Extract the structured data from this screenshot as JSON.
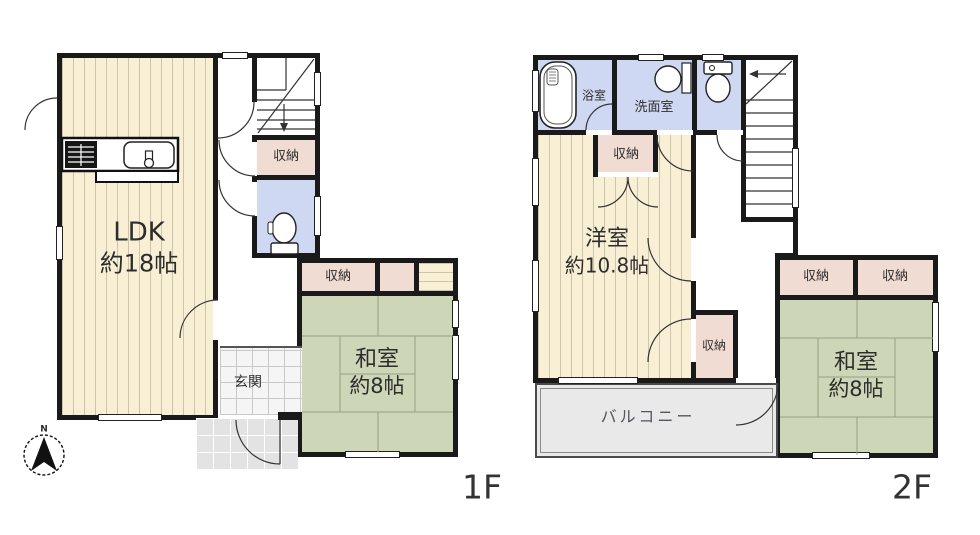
{
  "plan": {
    "floor1": {
      "floor_label": "1F",
      "ldk": {
        "name": "LDK",
        "size": "約18帖"
      },
      "hall_storage": "収納",
      "washitsu": {
        "name": "和室",
        "size": "約8帖"
      },
      "washitsu_storage": "収納",
      "genkan": "玄関"
    },
    "floor2": {
      "floor_label": "2F",
      "bathroom": "浴室",
      "washroom": "洗面室",
      "hall_storage": "収納",
      "yoshitsu": {
        "name": "洋室",
        "size": "約10.8帖"
      },
      "side_storage": "収納",
      "washitsu": {
        "name": "和室",
        "size": "約8帖"
      },
      "washitsu_storage_left": "収納",
      "washitsu_storage_right": "収納",
      "balcony": "バルコニー"
    },
    "compass_north": "N"
  },
  "colors": {
    "wall": "#1a1a1a",
    "wood_floor": "#f8efd5",
    "tatami": "#ced6b8",
    "storage": "#f0dcd2",
    "wet_area": "#cfd8f2",
    "balcony": "#e9e9e9",
    "porch": "#e3e3e3",
    "white": "#ffffff"
  }
}
